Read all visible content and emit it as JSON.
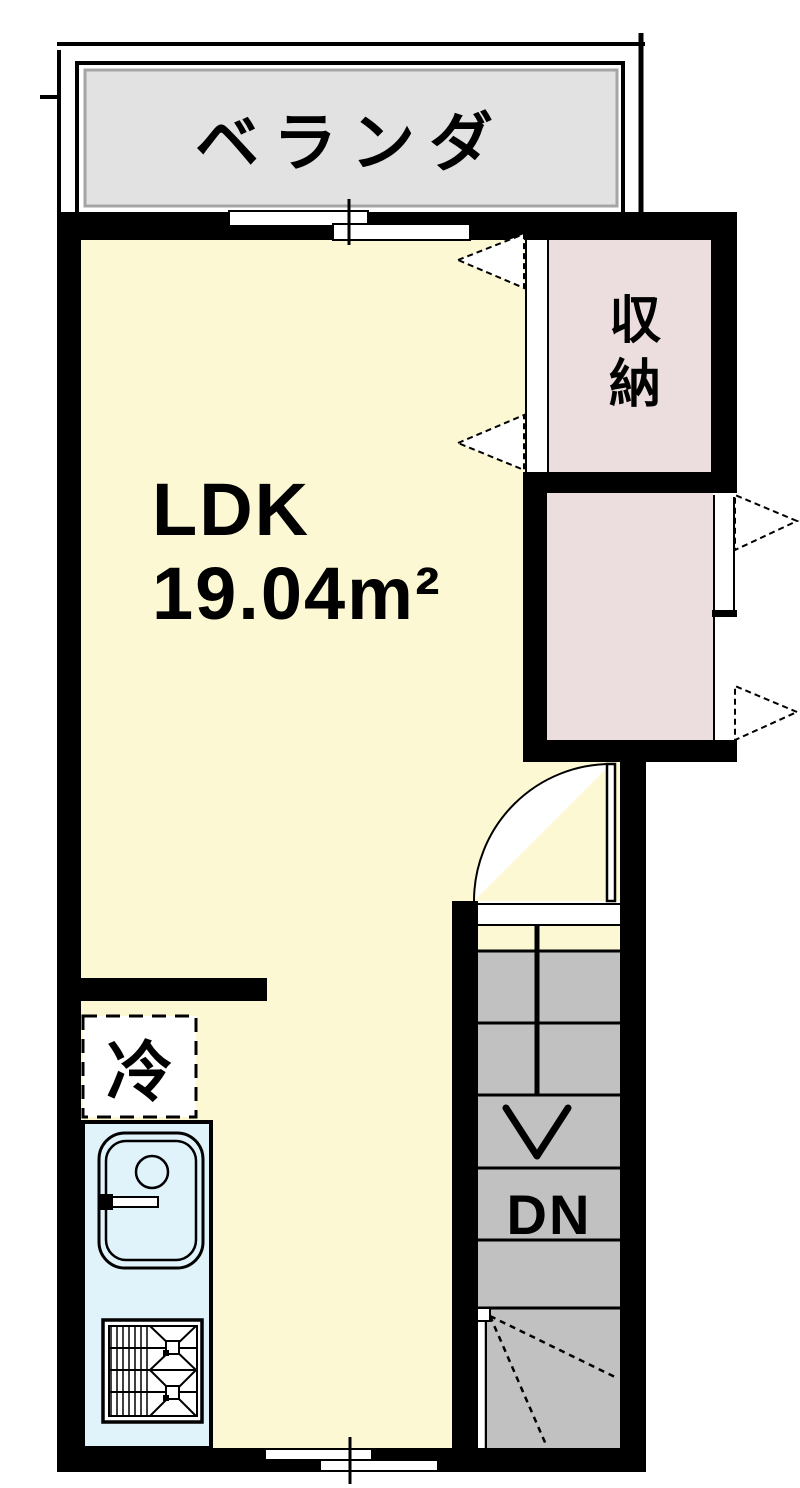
{
  "plan_title": "apartment-floor-plan",
  "rooms": {
    "veranda": {
      "label": "ベランダ"
    },
    "ldk": {
      "label": "LDK",
      "area": "19.04m²"
    },
    "storage": {
      "label": "収納"
    }
  },
  "fixtures": {
    "refrigerator": {
      "label": "冷"
    },
    "kitchen_sink_icon": "sink-with-faucet",
    "stove_icon": "two-burner-gas-stove"
  },
  "stairs": {
    "direction_label": "DN",
    "icon": "down-arrow"
  },
  "doors": {
    "storage_door_icon": "bifold-door",
    "closet_door_icon": "bifold-door",
    "entry_door_icon": "swing-door-arc"
  },
  "windows": {
    "top_window_icon": "sliding-window",
    "bottom_window_icon": "sliding-window"
  },
  "colors": {
    "wall": "#000000",
    "floor": "#FCF8D3",
    "closet": "#ECDEDE",
    "veranda": "#E2E2E2",
    "veranda_border": "#A5A5A5",
    "stairs": "#C1C1C1",
    "sink": "#E0F3FA"
  }
}
